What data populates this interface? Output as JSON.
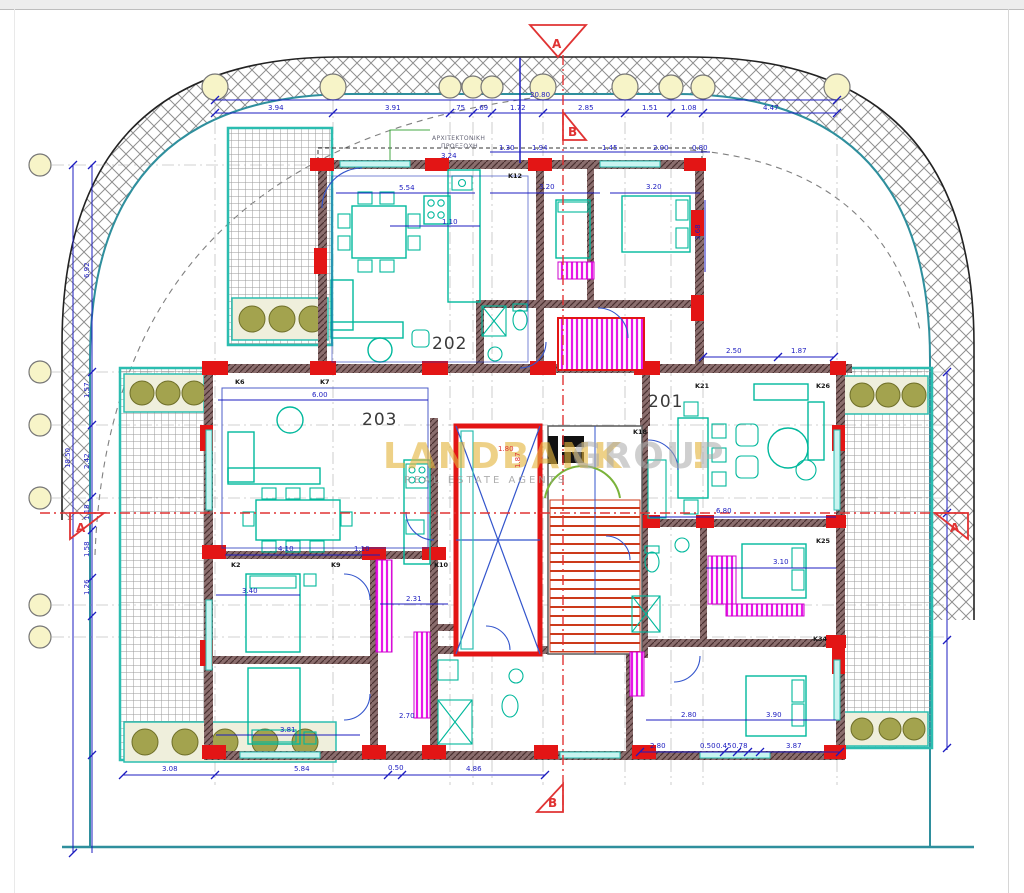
{
  "drawing_title": "floor-plan-level-2",
  "watermark": {
    "part1": "LANDBANK",
    "part2": "GROUP",
    "part3": "!",
    "tagline": "REAL ESTATE AGENTS"
  },
  "apartments": [
    {
      "t": "201",
      "x": 648,
      "y": 407
    },
    {
      "t": "202",
      "x": 432,
      "y": 349
    },
    {
      "t": "203",
      "x": 362,
      "y": 425
    }
  ],
  "sections": [
    {
      "t": "A",
      "x": 552,
      "y": 48
    },
    {
      "t": "B",
      "x": 568,
      "y": 136
    },
    {
      "t": "A",
      "x": 76,
      "y": 532
    },
    {
      "t": "A",
      "x": 950,
      "y": 532
    },
    {
      "t": "B",
      "x": 548,
      "y": 807
    }
  ],
  "notes": [
    {
      "t": "ΑΡΧΙΤΕΚΤΟΝΙΚΗ",
      "x": 432,
      "y": 140
    },
    {
      "t": "ΠΡΟΕΞΟΧΗ",
      "x": 441,
      "y": 148
    }
  ],
  "columns": [
    {
      "t": "K6",
      "x": 235,
      "y": 384
    },
    {
      "t": "K7",
      "x": 320,
      "y": 384
    },
    {
      "t": "K12",
      "x": 508,
      "y": 178
    },
    {
      "t": "K18",
      "x": 633,
      "y": 434
    },
    {
      "t": "K21",
      "x": 695,
      "y": 388
    },
    {
      "t": "K26",
      "x": 816,
      "y": 388
    },
    {
      "t": "K2",
      "x": 231,
      "y": 567
    },
    {
      "t": "K9",
      "x": 331,
      "y": 567
    },
    {
      "t": "K10",
      "x": 434,
      "y": 567
    },
    {
      "t": "K25",
      "x": 816,
      "y": 543
    },
    {
      "t": "K34",
      "x": 813,
      "y": 641
    }
  ],
  "dims": [
    {
      "t": "20.80",
      "x": 530,
      "y": 97
    },
    {
      "t": "3.94",
      "x": 268,
      "y": 110
    },
    {
      "t": "3.91",
      "x": 385,
      "y": 110
    },
    {
      "t": ".75",
      "x": 454,
      "y": 110
    },
    {
      "t": ".69",
      "x": 477,
      "y": 110
    },
    {
      "t": "1.72",
      "x": 510,
      "y": 110
    },
    {
      "t": "2.85",
      "x": 578,
      "y": 110
    },
    {
      "t": "1.51",
      "x": 642,
      "y": 110
    },
    {
      "t": "1.08",
      "x": 681,
      "y": 110
    },
    {
      "t": "4.47",
      "x": 763,
      "y": 110
    },
    {
      "t": "1.30",
      "x": 499,
      "y": 150
    },
    {
      "t": "1.94",
      "x": 532,
      "y": 150
    },
    {
      "t": "1.45",
      "x": 602,
      "y": 150
    },
    {
      "t": "2.00",
      "x": 653,
      "y": 150
    },
    {
      "t": "0.80",
      "x": 692,
      "y": 150
    },
    {
      "t": "3.24",
      "x": 441,
      "y": 158
    },
    {
      "t": "5.54",
      "x": 399,
      "y": 190
    },
    {
      "t": "3.20",
      "x": 539,
      "y": 189
    },
    {
      "t": "3.20",
      "x": 646,
      "y": 189
    },
    {
      "t": "1.10",
      "x": 442,
      "y": 224
    },
    {
      "t": "2.50",
      "x": 726,
      "y": 353
    },
    {
      "t": "1.87",
      "x": 791,
      "y": 353
    },
    {
      "t": "3.68",
      "x": 700,
      "y": 240,
      "r": -90
    },
    {
      "t": "6.00",
      "x": 312,
      "y": 397
    },
    {
      "t": "4.10",
      "x": 278,
      "y": 551
    },
    {
      "t": "1.10",
      "x": 354,
      "y": 551
    },
    {
      "t": "6.80",
      "x": 716,
      "y": 513
    },
    {
      "t": "18.50",
      "x": 70,
      "y": 468,
      "r": -90
    },
    {
      "t": "6.92",
      "x": 89,
      "y": 278,
      "r": -90
    },
    {
      "t": "1.57",
      "x": 89,
      "y": 398,
      "r": -90
    },
    {
      "t": "2.42",
      "x": 89,
      "y": 469,
      "r": -90
    },
    {
      "t": "1.18",
      "x": 89,
      "y": 520,
      "r": -90
    },
    {
      "t": "1.58",
      "x": 89,
      "y": 557,
      "r": -90
    },
    {
      "t": "1.26",
      "x": 89,
      "y": 595,
      "r": -90
    },
    {
      "t": "3.40",
      "x": 242,
      "y": 593
    },
    {
      "t": "2.31",
      "x": 406,
      "y": 601
    },
    {
      "t": "3.10",
      "x": 773,
      "y": 564
    },
    {
      "t": "2.70",
      "x": 399,
      "y": 718
    },
    {
      "t": "3.81",
      "x": 280,
      "y": 732
    },
    {
      "t": "3.90",
      "x": 766,
      "y": 717
    },
    {
      "t": "2.80",
      "x": 681,
      "y": 717
    },
    {
      "t": "3.08",
      "x": 162,
      "y": 771
    },
    {
      "t": "5.84",
      "x": 294,
      "y": 771
    },
    {
      "t": "0.50",
      "x": 388,
      "y": 770
    },
    {
      "t": "4.86",
      "x": 466,
      "y": 771
    },
    {
      "t": "2.80",
      "x": 650,
      "y": 748
    },
    {
      "t": "0.50",
      "x": 700,
      "y": 748
    },
    {
      "t": "0.45",
      "x": 716,
      "y": 748
    },
    {
      "t": "0.78",
      "x": 732,
      "y": 748
    },
    {
      "t": "3.87",
      "x": 786,
      "y": 748
    },
    {
      "t": "1.80",
      "x": 498,
      "y": 451,
      "c": "red"
    },
    {
      "t": "1.87",
      "x": 520,
      "y": 468,
      "r": -90,
      "c": "red"
    }
  ],
  "colors": {
    "dimension_blue": "#1c1cc0",
    "wall_red": "#e31515",
    "wall_dark": "#8a6d6d",
    "furniture_teal": "#00b89c",
    "boundary_teal": "#2f8f9d",
    "wardrobe_magenta": "#e816e8",
    "planter_olive": "#a3a34e",
    "section_red": "#e03333",
    "watermark_gold": "#e4b53e"
  }
}
